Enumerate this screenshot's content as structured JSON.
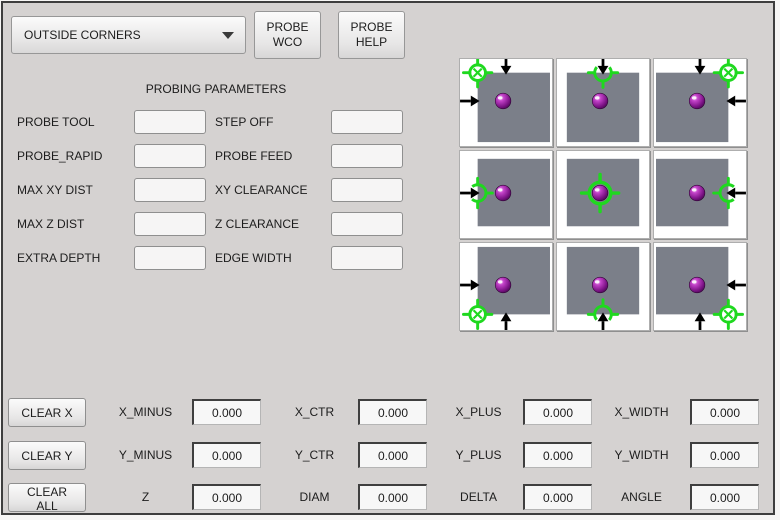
{
  "toolbar": {
    "mode_select": {
      "value": "OUTSIDE CORNERS"
    },
    "probe_wco_label": "PROBE\nWCO",
    "probe_help_label": "PROBE\nHELP"
  },
  "parameters": {
    "title": "PROBING PARAMETERS",
    "rows": [
      {
        "left": {
          "label": "PROBE TOOL",
          "value": ""
        },
        "right": {
          "label": "STEP OFF",
          "value": ""
        }
      },
      {
        "left": {
          "label": "PROBE_RAPID",
          "value": ""
        },
        "right": {
          "label": "PROBE FEED",
          "value": ""
        }
      },
      {
        "left": {
          "label": "MAX XY DIST",
          "value": ""
        },
        "right": {
          "label": "XY CLEARANCE",
          "value": ""
        }
      },
      {
        "left": {
          "label": "MAX Z DIST",
          "value": ""
        },
        "right": {
          "label": "Z CLEARANCE",
          "value": ""
        }
      },
      {
        "left": {
          "label": "EXTRA DEPTH",
          "value": ""
        },
        "right": {
          "label": "EDGE WIDTH",
          "value": ""
        }
      }
    ]
  },
  "probe_diagram": {
    "colors": {
      "material": "#7b7f89",
      "target": "#1fd81f",
      "arrow": "#000000",
      "ball_stops": [
        "#f2b6f2",
        "#c343c9",
        "#7c1386",
        "#41074a"
      ]
    },
    "cells": [
      {
        "position": "top-left",
        "target": "corner",
        "arrows": [
          "down",
          "right"
        ]
      },
      {
        "position": "top-center",
        "target": "edge-top",
        "arrows": [
          "down"
        ]
      },
      {
        "position": "top-right",
        "target": "corner",
        "arrows": [
          "down",
          "left"
        ]
      },
      {
        "position": "middle-left",
        "target": "edge-left",
        "arrows": [
          "right"
        ]
      },
      {
        "position": "center",
        "target": "center",
        "arrows": []
      },
      {
        "position": "middle-right",
        "target": "edge-right",
        "arrows": [
          "left"
        ]
      },
      {
        "position": "bottom-left",
        "target": "corner",
        "arrows": [
          "right",
          "up"
        ]
      },
      {
        "position": "bottom-center",
        "target": "edge-bottom",
        "arrows": [
          "up"
        ]
      },
      {
        "position": "bottom-right",
        "target": "corner",
        "arrows": [
          "left",
          "up"
        ]
      }
    ]
  },
  "results": {
    "clear_buttons": [
      "CLEAR X",
      "CLEAR Y",
      "CLEAR ALL"
    ],
    "rows": [
      {
        "cells": [
          {
            "label": "X_MINUS",
            "value": "0.000"
          },
          {
            "label": "X_CTR",
            "value": "0.000"
          },
          {
            "label": "X_PLUS",
            "value": "0.000"
          },
          {
            "label": "X_WIDTH",
            "value": "0.000"
          }
        ]
      },
      {
        "cells": [
          {
            "label": "Y_MINUS",
            "value": "0.000"
          },
          {
            "label": "Y_CTR",
            "value": "0.000"
          },
          {
            "label": "Y_PLUS",
            "value": "0.000"
          },
          {
            "label": "Y_WIDTH",
            "value": "0.000"
          }
        ]
      },
      {
        "cells": [
          {
            "label": "Z",
            "value": "0.000"
          },
          {
            "label": "DIAM",
            "value": "0.000"
          },
          {
            "label": "DELTA",
            "value": "0.000"
          },
          {
            "label": "ANGLE",
            "value": "0.000"
          }
        ]
      }
    ]
  }
}
